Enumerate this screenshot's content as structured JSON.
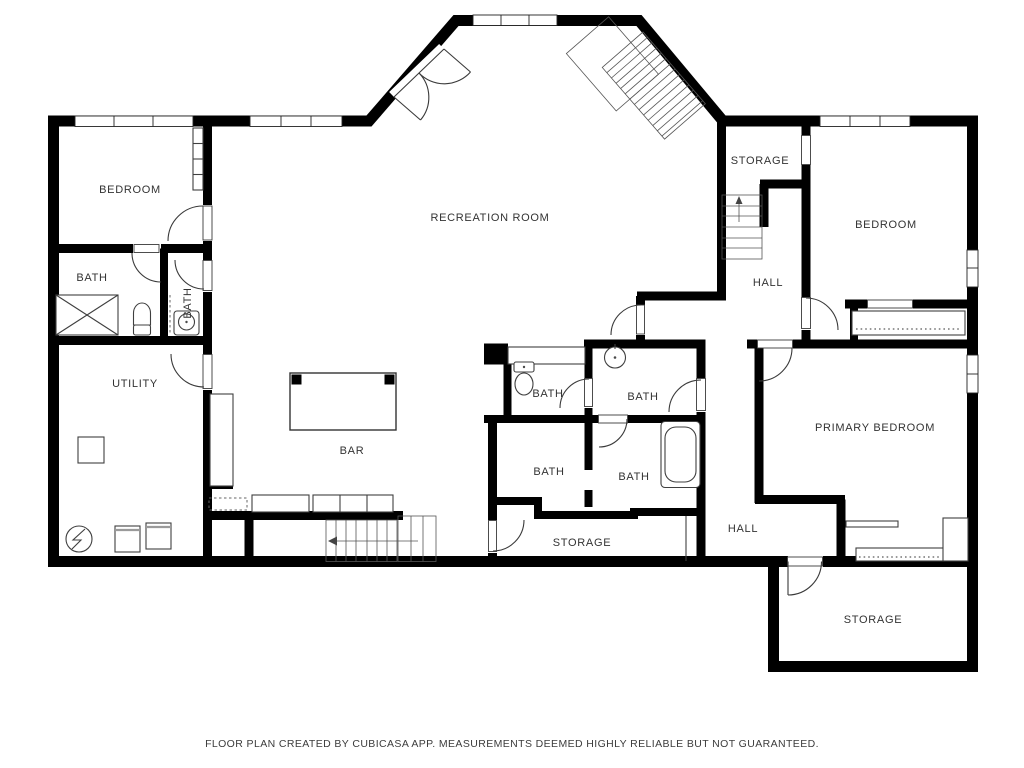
{
  "floorplan": {
    "rooms": {
      "bedroom_tl": {
        "label": "BEDROOM"
      },
      "bath_left1": {
        "label": "BATH"
      },
      "bath_left2": {
        "label": "BATH"
      },
      "utility": {
        "label": "UTILITY"
      },
      "recreation": {
        "label": "RECREATION ROOM"
      },
      "bar": {
        "label": "BAR"
      },
      "bath_c_tl": {
        "label": "BATH"
      },
      "bath_c_tr": {
        "label": "BATH"
      },
      "bath_c_bl": {
        "label": "BATH"
      },
      "bath_c_br": {
        "label": "BATH"
      },
      "storage_center": {
        "label": "STORAGE"
      },
      "storage_top": {
        "label": "STORAGE"
      },
      "hall_upper": {
        "label": "HALL"
      },
      "bedroom_tr": {
        "label": "BEDROOM"
      },
      "primary_bedroom": {
        "label": "PRIMARY BEDROOM"
      },
      "hall_lower": {
        "label": "HALL"
      },
      "storage_br": {
        "label": "STORAGE"
      }
    },
    "footer": "FLOOR PLAN CREATED BY CUBICASA APP. MEASUREMENTS DEEMED HIGHLY RELIABLE BUT NOT GUARANTEED.",
    "colors": {
      "wall": "#000000",
      "background": "#ffffff",
      "fixture_stroke": "#4a4a4a",
      "label": "#333333"
    }
  }
}
